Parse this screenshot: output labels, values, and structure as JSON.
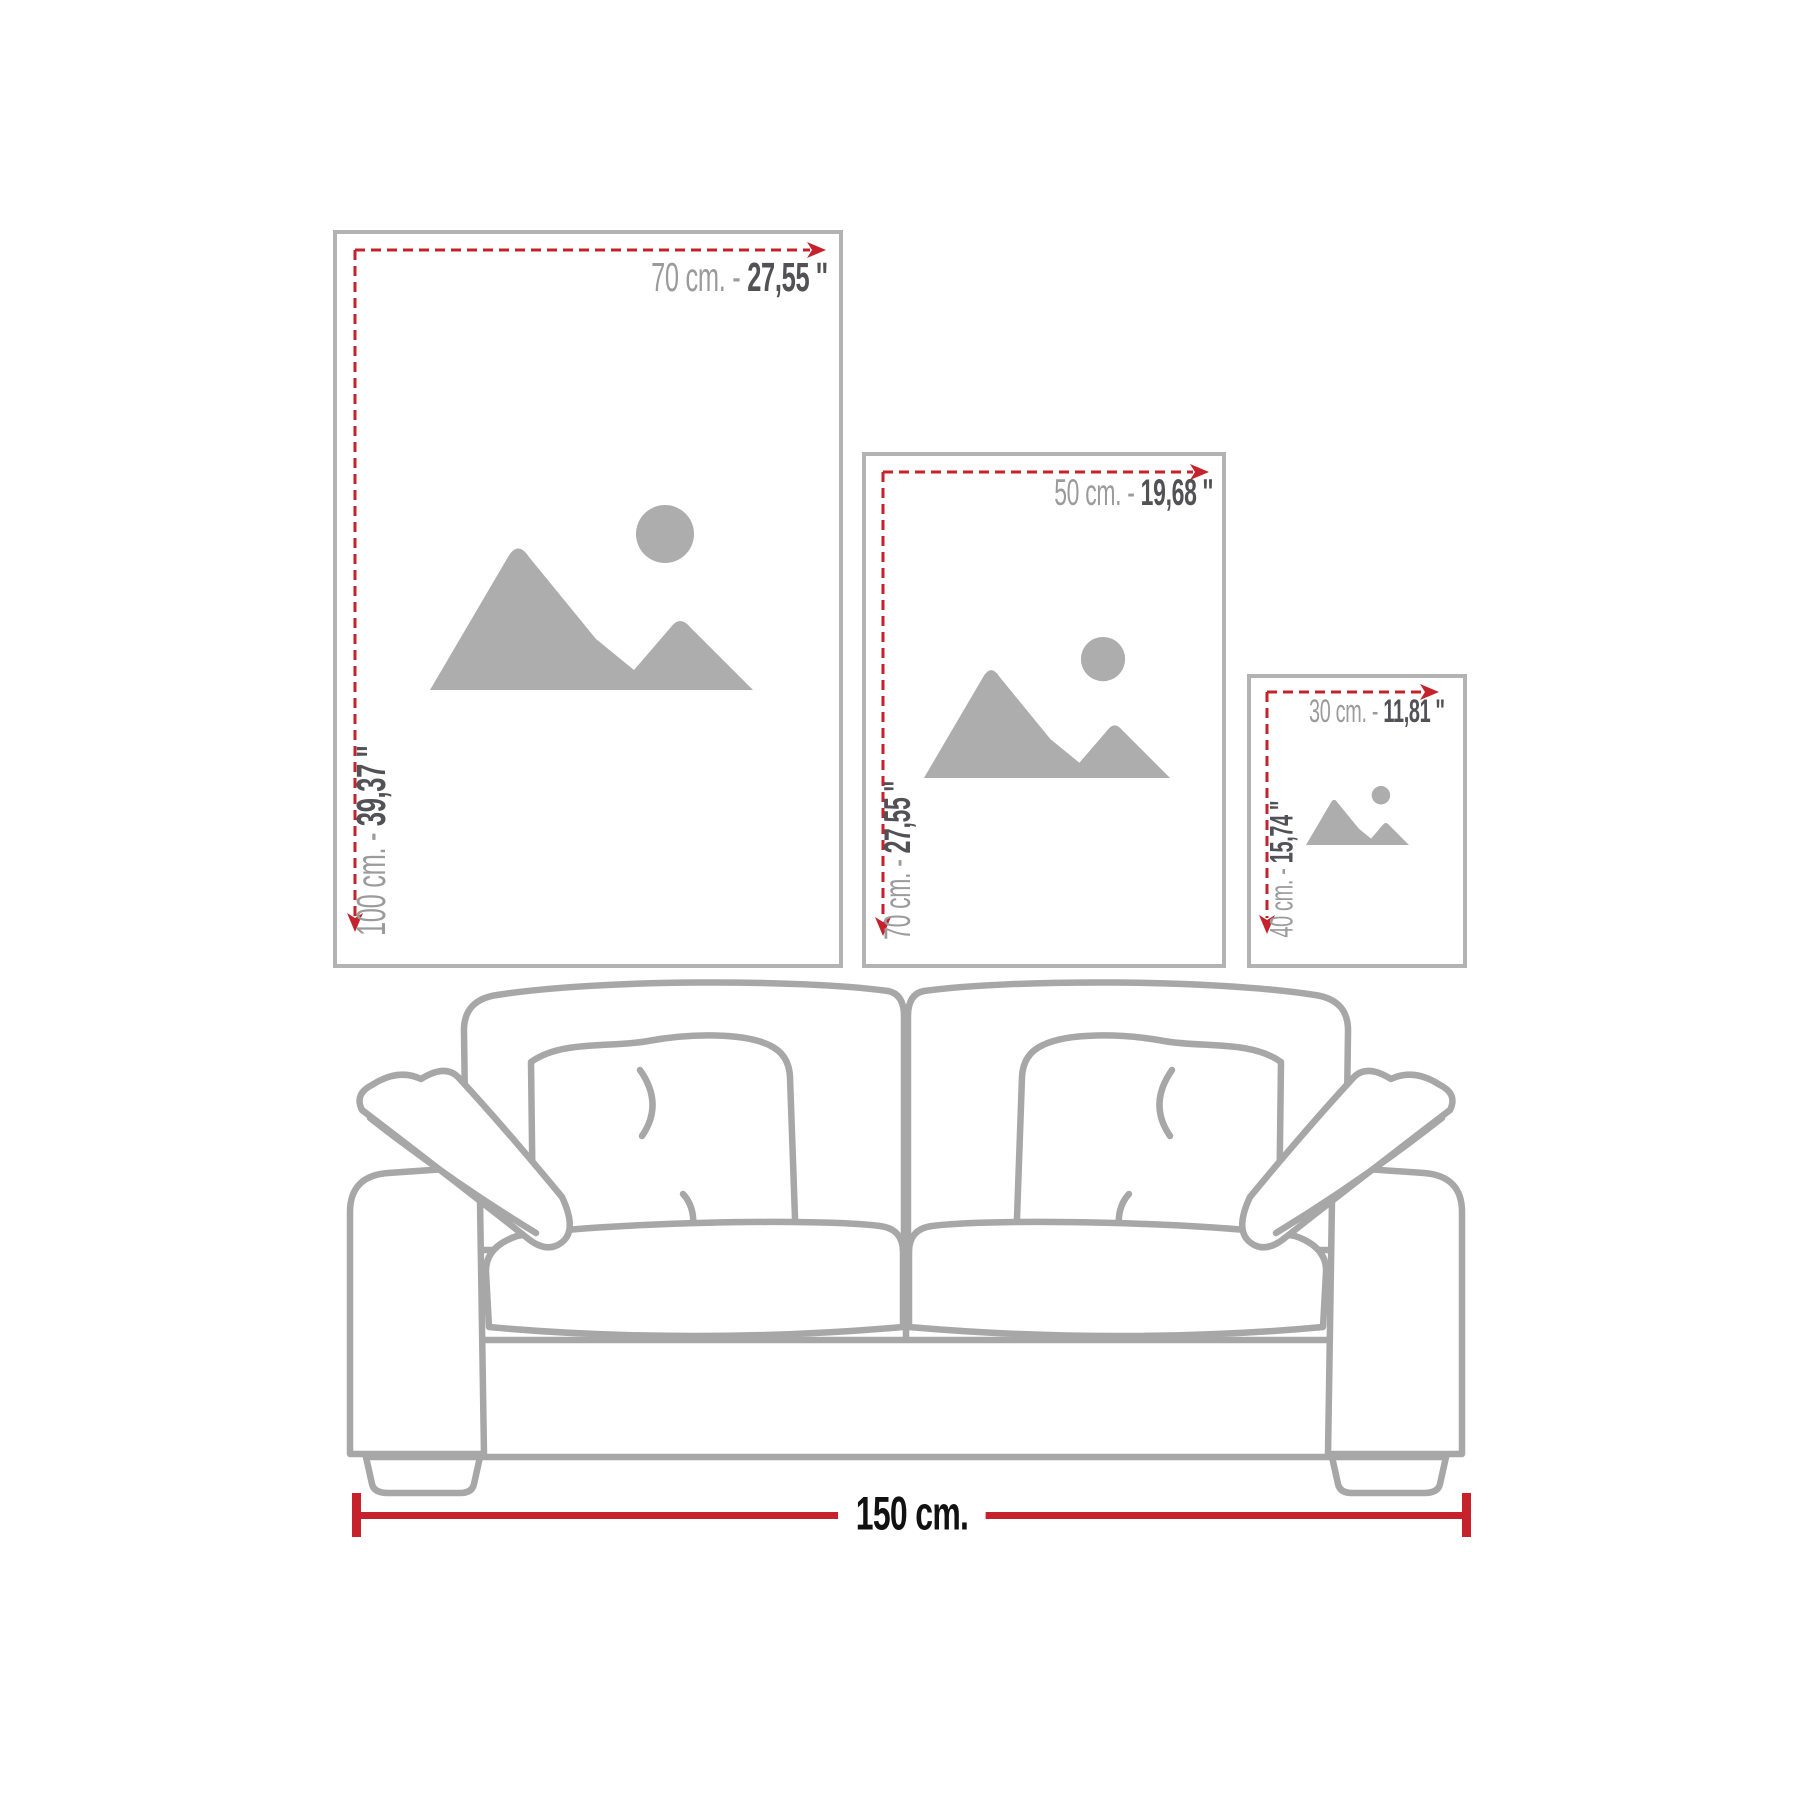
{
  "frames": [
    {
      "name": "large",
      "width_cm": "70 cm. -",
      "width_in": "27,55 ''",
      "height_cm": "100 cm. -",
      "height_in": "39,37 ''"
    },
    {
      "name": "medium",
      "width_cm": "50 cm. -",
      "width_in": "19,68 ''",
      "height_cm": "70 cm. -",
      "height_in": "27,55 ''"
    },
    {
      "name": "small",
      "width_cm": "30 cm. -",
      "width_in": "11,81 ''",
      "height_cm": "40 cm. -",
      "height_in": "15,74 ''"
    }
  ],
  "sofa": {
    "width_label": "150 cm."
  },
  "icons": {
    "placeholder": "image-placeholder-mountains-sun",
    "dimension_arrow": "red-dashed-arrow"
  },
  "colors": {
    "accent_red": "#c5222b",
    "frame_border": "#b3b3b3",
    "sofa_line": "#a7a7a7",
    "icon_gray": "#adadad",
    "label_gray": "#9b9b9b",
    "label_dark": "#515156",
    "footer_text": "#111111",
    "background": "#ffffff"
  }
}
